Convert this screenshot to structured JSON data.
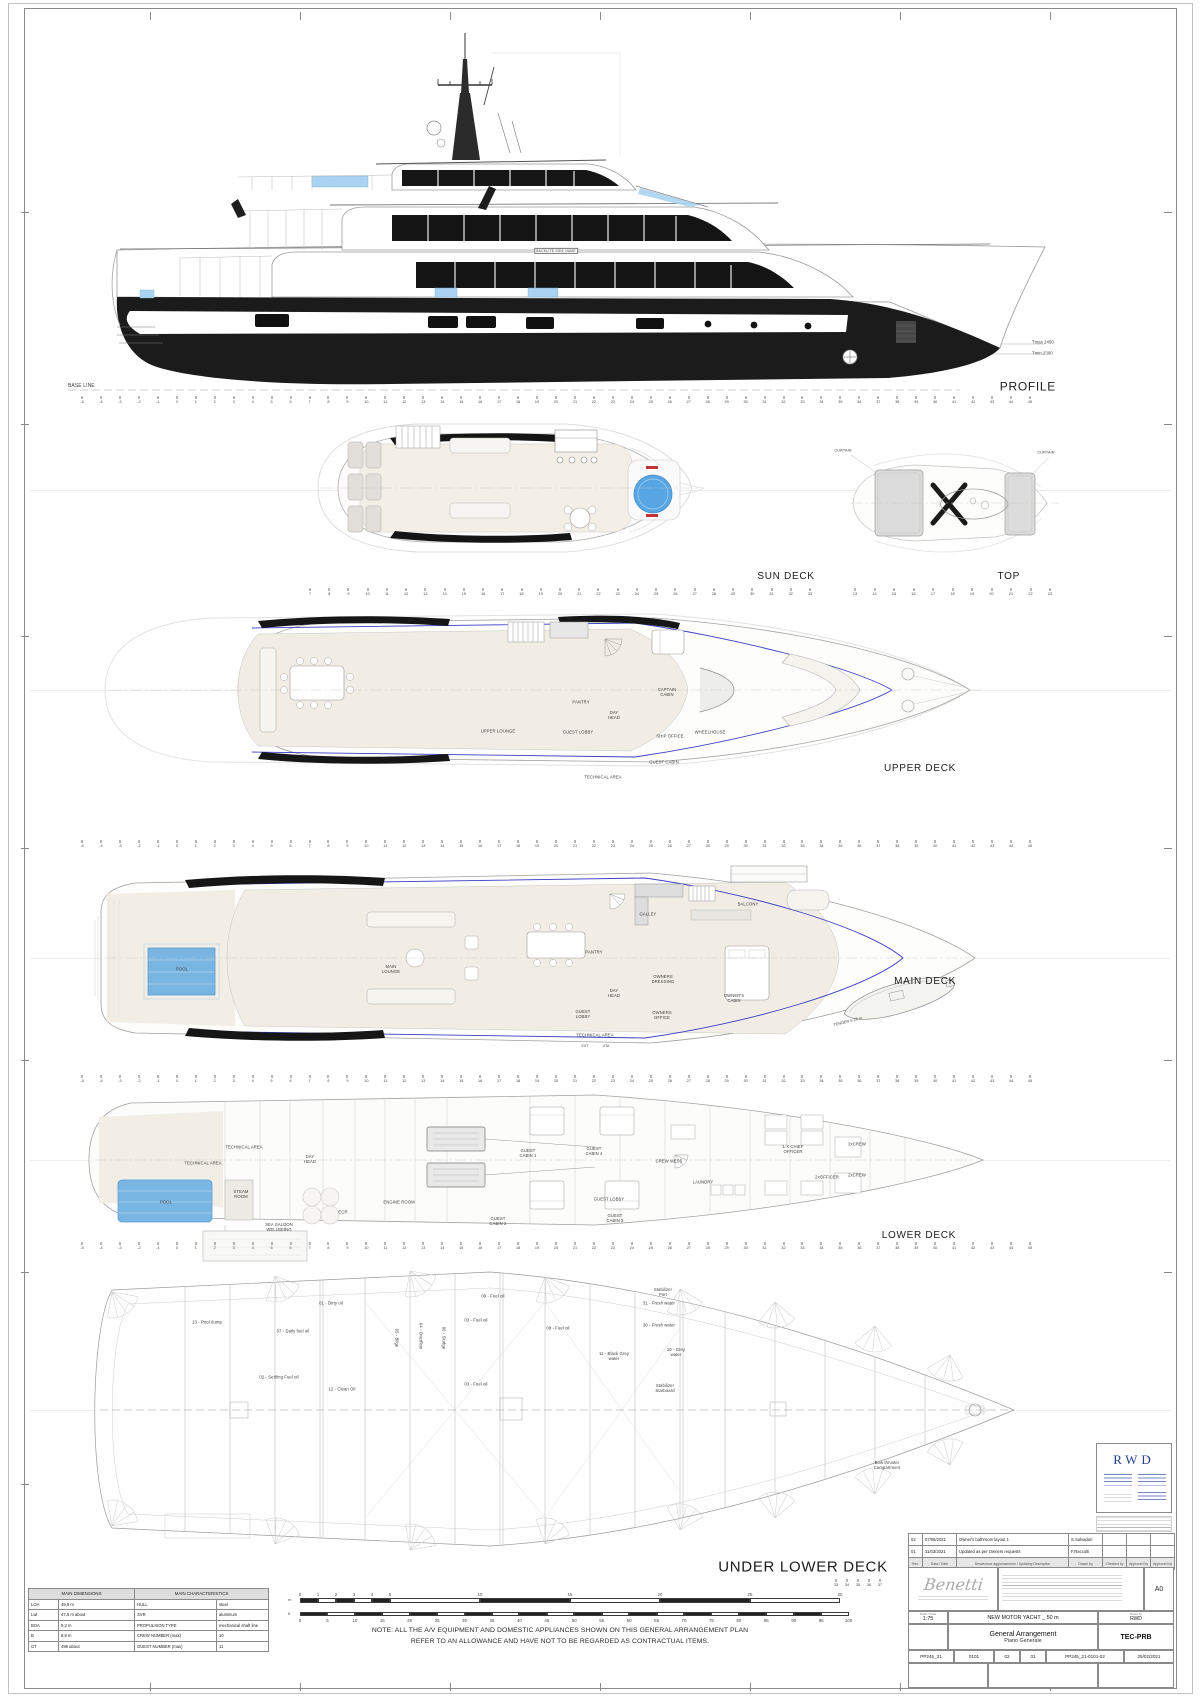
{
  "profile": {
    "label": "PROFILE",
    "base_line": "BASE LINE",
    "backlite": "BACKLITE SIDE NAME",
    "tmax": "Tmax 2450",
    "tmin": "Tmin 2300"
  },
  "decks": [
    {
      "id": "sun-deck",
      "label": "SUN DECK",
      "label_x": 786,
      "label_y": 577,
      "label_size": 10,
      "align": "center",
      "rooms": []
    },
    {
      "id": "top",
      "label": "TOP",
      "label_x": 1020,
      "label_y": 577,
      "label_size": 10,
      "align": "right",
      "rooms": [
        {
          "label": "CURTAIN",
          "x": 843,
          "y": 451,
          "size": 3.8
        },
        {
          "label": "CURTAIN",
          "x": 1046,
          "y": 453,
          "size": 3.8
        }
      ]
    },
    {
      "id": "upper-deck",
      "label": "UPPER DECK",
      "label_x": 956,
      "label_y": 769,
      "label_size": 10,
      "align": "right",
      "rooms": [
        {
          "label": "UPPER LOUNGE",
          "x": 498,
          "y": 731
        },
        {
          "label": "PANTRY",
          "x": 581,
          "y": 702
        },
        {
          "label": "DAY\nHEAD",
          "x": 614,
          "y": 715
        },
        {
          "label": "GUEST LOBBY",
          "x": 578,
          "y": 732
        },
        {
          "label": "TECHNICAL AREA",
          "x": 603,
          "y": 777
        },
        {
          "label": "GUEST CABIN",
          "x": 664,
          "y": 762
        },
        {
          "label": "SHIP OFFICE",
          "x": 670,
          "y": 736
        },
        {
          "label": "CAPTAIN\nCABIN",
          "x": 667,
          "y": 692
        },
        {
          "label": "WHEELHOUSE",
          "x": 710,
          "y": 732
        }
      ]
    },
    {
      "id": "main-deck",
      "label": "MAIN DECK",
      "label_x": 956,
      "label_y": 982,
      "label_size": 10,
      "align": "right",
      "rooms": [
        {
          "label": "POOL",
          "x": 182,
          "y": 969
        },
        {
          "label": "MAIN\nLOUNGE",
          "x": 391,
          "y": 969
        },
        {
          "label": "GALLEY",
          "x": 648,
          "y": 914
        },
        {
          "label": "PANTRY",
          "x": 594,
          "y": 952
        },
        {
          "label": "BALCONY",
          "x": 748,
          "y": 904
        },
        {
          "label": "DAY\nHEAD",
          "x": 614,
          "y": 993
        },
        {
          "label": "OWNERS\nDRESSING",
          "x": 663,
          "y": 979
        },
        {
          "label": "OWNER'S\nCABIN",
          "x": 734,
          "y": 998
        },
        {
          "label": "GUEST\nLOBBY",
          "x": 583,
          "y": 1014
        },
        {
          "label": "OWNERS\nOFFICE",
          "x": 662,
          "y": 1015
        },
        {
          "label": "TECHNICAL AREA",
          "x": 595,
          "y": 1035
        },
        {
          "label": "EXT",
          "x": 585,
          "y": 1046,
          "size": 3.4
        },
        {
          "label": "UTA",
          "x": 606,
          "y": 1046,
          "size": 3.4
        },
        {
          "label": "TENDER  6.25 m",
          "x": 848,
          "y": 1022,
          "rot": -14,
          "size": 3.8
        }
      ]
    },
    {
      "id": "lower-deck",
      "label": "LOWER DECK",
      "label_x": 956,
      "label_y": 1236,
      "label_size": 10,
      "align": "right",
      "rooms": [
        {
          "label": "TECHNICAL AREA",
          "x": 244,
          "y": 1147
        },
        {
          "label": "TECHNICAL AREA",
          "x": 203,
          "y": 1163
        },
        {
          "label": "DAY\nHEAD",
          "x": 310,
          "y": 1159
        },
        {
          "label": "STEAM\nROOM",
          "x": 241,
          "y": 1194
        },
        {
          "label": "POOL",
          "x": 166,
          "y": 1202
        },
        {
          "label": "SEA SALOON\nWELLBEING",
          "x": 279,
          "y": 1227
        },
        {
          "label": "ECR",
          "x": 343,
          "y": 1212
        },
        {
          "label": "ENGINE ROOM",
          "x": 399,
          "y": 1202
        },
        {
          "label": "GUEST\nCABIN 1",
          "x": 528,
          "y": 1153
        },
        {
          "label": "GUEST\nCABIN 4",
          "x": 594,
          "y": 1151
        },
        {
          "label": "GUEST LOBBY",
          "x": 609,
          "y": 1199
        },
        {
          "label": "GUEST\nCABIN 2",
          "x": 498,
          "y": 1221
        },
        {
          "label": "GUEST\nCABIN 3",
          "x": 615,
          "y": 1218
        },
        {
          "label": "CREW MESS",
          "x": 669,
          "y": 1161
        },
        {
          "label": "LAUNDRY",
          "x": 703,
          "y": 1182
        },
        {
          "label": "1 X CHIEF\nOFFICER",
          "x": 793,
          "y": 1149
        },
        {
          "label": "2xOFFICER",
          "x": 827,
          "y": 1177
        },
        {
          "label": "2xCREW",
          "x": 857,
          "y": 1144
        },
        {
          "label": "2xCREW",
          "x": 857,
          "y": 1175
        }
      ]
    },
    {
      "id": "under-lower-deck",
      "label": "UNDER LOWER DECK",
      "label_x": 803,
      "label_y": 1568,
      "label_size": 15,
      "align": "center",
      "rooms": [
        {
          "label": "13 - Pool dump",
          "x": 207,
          "y": 1322
        },
        {
          "label": "01 - Dirty oil",
          "x": 331,
          "y": 1303
        },
        {
          "label": "07 - Daily fuel oil",
          "x": 293,
          "y": 1331
        },
        {
          "label": "02 - Settling Fuel oil",
          "x": 279,
          "y": 1377
        },
        {
          "label": "12 - Clean Oil",
          "x": 342,
          "y": 1389
        },
        {
          "label": "05 - Bilge",
          "x": 397,
          "y": 1338,
          "rot": 90
        },
        {
          "label": "04 - Overflow",
          "x": 421,
          "y": 1336,
          "rot": 90
        },
        {
          "label": "06 - Sludge",
          "x": 444,
          "y": 1338,
          "rot": 90
        },
        {
          "label": "03 - Fuel oil",
          "x": 476,
          "y": 1320
        },
        {
          "label": "09 - Fuel oil",
          "x": 493,
          "y": 1296
        },
        {
          "label": "03 - Fuel oil",
          "x": 476,
          "y": 1384
        },
        {
          "label": "08 - Fuel oil",
          "x": 558,
          "y": 1328
        },
        {
          "label": "11 - Black Grey\nwater",
          "x": 614,
          "y": 1356
        },
        {
          "label": "31 - Fresh water",
          "x": 659,
          "y": 1303
        },
        {
          "label": "30 - Fresh water",
          "x": 659,
          "y": 1325
        },
        {
          "label": "10 - Grey\nwater",
          "x": 676,
          "y": 1352
        },
        {
          "label": "Stabilizer\nPort",
          "x": 663,
          "y": 1292
        },
        {
          "label": "Stabilizer\nStarboard",
          "x": 665,
          "y": 1388
        },
        {
          "label": "Bow thruster\nCompartment",
          "x": 887,
          "y": 1465
        }
      ]
    }
  ],
  "rulers": [
    {
      "name": "profile-ruler",
      "y": 396,
      "x1": 82,
      "x2": 1030,
      "from": -5,
      "to": 45
    },
    {
      "name": "sun-deck-ruler",
      "y": 588,
      "x1": 310,
      "x2": 810,
      "from": 7,
      "to": 33
    },
    {
      "name": "top-ruler",
      "y": 588,
      "x1": 855,
      "x2": 1050,
      "from": 13,
      "to": 23
    },
    {
      "name": "upper-deck-ruler",
      "y": 840,
      "x1": 82,
      "x2": 1030,
      "from": -5,
      "to": 45
    },
    {
      "name": "main-deck-ruler",
      "y": 1075,
      "x1": 82,
      "x2": 1030,
      "from": -5,
      "to": 45
    },
    {
      "name": "lower-deck-ruler",
      "y": 1242,
      "x1": 82,
      "x2": 1030,
      "from": -5,
      "to": 45
    },
    {
      "name": "under-lower-ruler",
      "y": 1579,
      "x1": 836,
      "x2": 880,
      "from": 33,
      "to": 37
    }
  ],
  "dimensions_table": {
    "left_header": "MAIN DIMENSIONS",
    "right_header": "MAIN CHARACTERISTICS",
    "rows": [
      [
        "LOA",
        "49,9 m",
        "HULL",
        "steel"
      ],
      [
        "Lwl",
        "47,5 m about",
        "SVR",
        "aluminum"
      ],
      [
        "BOA",
        "9,2 m",
        "PROPULSION TYPE",
        "mechanical shaft line"
      ],
      [
        "B",
        "8,9 m",
        "CREW NUMBER (max)",
        "10"
      ],
      [
        "GT",
        "499 about",
        "GUEST NUMBER (max)",
        "11"
      ]
    ]
  },
  "scale_bar": {
    "unit_top": "m",
    "unit_bottom": "ft",
    "metric_labels": [
      "0",
      "1",
      "2",
      "3",
      "4",
      "5",
      "10",
      "15",
      "20",
      "25",
      "30"
    ],
    "feet_labels": [
      "0",
      "5",
      "10",
      "15",
      "20",
      "25",
      "30",
      "35",
      "40",
      "45",
      "50",
      "55",
      "60",
      "65",
      "70",
      "75",
      "80",
      "85",
      "90",
      "95",
      "100"
    ]
  },
  "note": [
    "NOTE: ALL THE A/V EQUIPMENT AND DOMESTIC APPLIANCES SHOWN ON THIS GENERAL ARRANGEMENT PLAN",
    "REFER TO AN ALLOWANCE AND HAVE NOT TO BE REGARDED AS CONTRACTUAL ITEMS."
  ],
  "title_block": {
    "rwd_logo": "RWD",
    "revisions": [
      {
        "rev": "02",
        "date": "07/06/2021",
        "desc": "Owner's bathroom layout 1",
        "by": "S.Salvadori",
        "checked": "",
        "approved": "",
        "approved2": ""
      },
      {
        "rev": "01",
        "date": "11/03/2021",
        "desc": "Updated as per Owners requests",
        "by": "F.Raccolti",
        "checked": "",
        "approved": "",
        "approved2": ""
      }
    ],
    "rev_header": {
      "rev": "Rev.",
      "date": "Data / Date",
      "desc": "Descrizione aggiornamento / Updating Description",
      "by": "Drawn by",
      "checked": "Checked by",
      "approved": "Approved by",
      "approved2": "Approved by"
    },
    "builder_logo": "Benetti",
    "sheet_size": "A0",
    "scale_label": "Scala / Scale",
    "scale": "1:75",
    "project": "NEW MOTOR YACHT _ 50 m",
    "title_en": "General Arrangement",
    "title_it": "Piano Generale",
    "drawn_by_label": "Drawn by",
    "drawn_by": "RWD",
    "code": "TEC-PRB",
    "doc_row": [
      "PP245_21",
      "0101",
      "02",
      "01",
      "PP245_21-0101-02",
      "25/02/2021"
    ]
  }
}
